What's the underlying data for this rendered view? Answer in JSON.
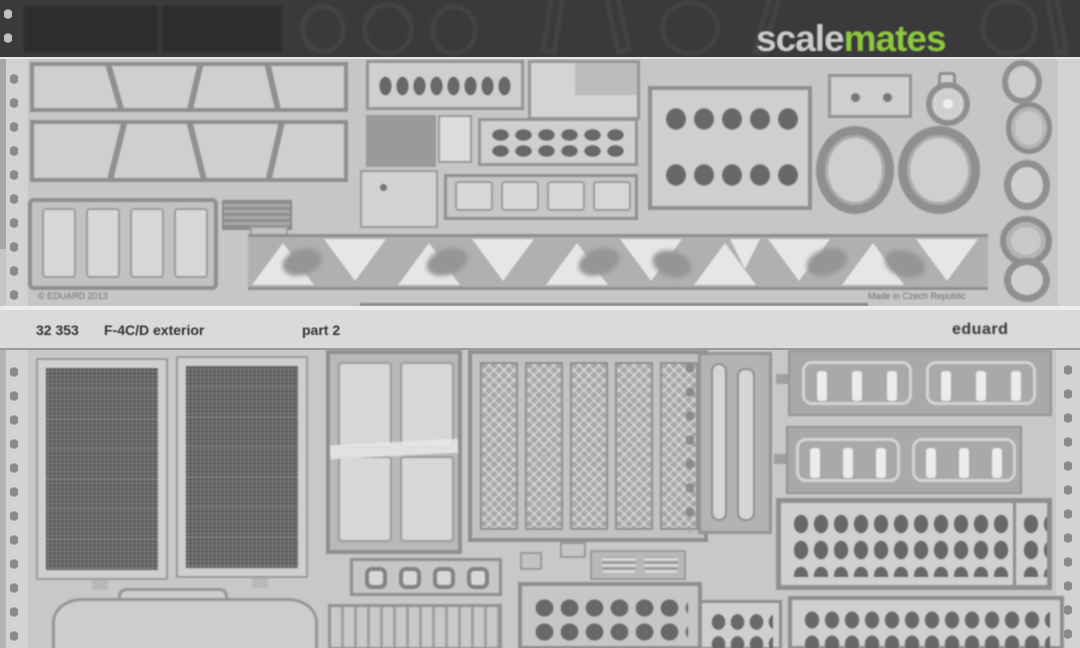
{
  "watermark": {
    "scale": "scale",
    "mates": "mates"
  },
  "upper_sheet": {
    "copyright_text": "© EDUARD 2013",
    "origin_text": "Made in Czech Republic"
  },
  "label_band": {
    "set_number": "32 353",
    "title": "F-4C/D exterior",
    "part": "part 2",
    "brand": "eduard"
  },
  "colors": {
    "watermark_green": "#8dc63f",
    "sheet_grey": "#c8c8c8",
    "dark_band": "#3a3a3c",
    "mesh_dark": "#797979",
    "label_text": "#333333"
  }
}
